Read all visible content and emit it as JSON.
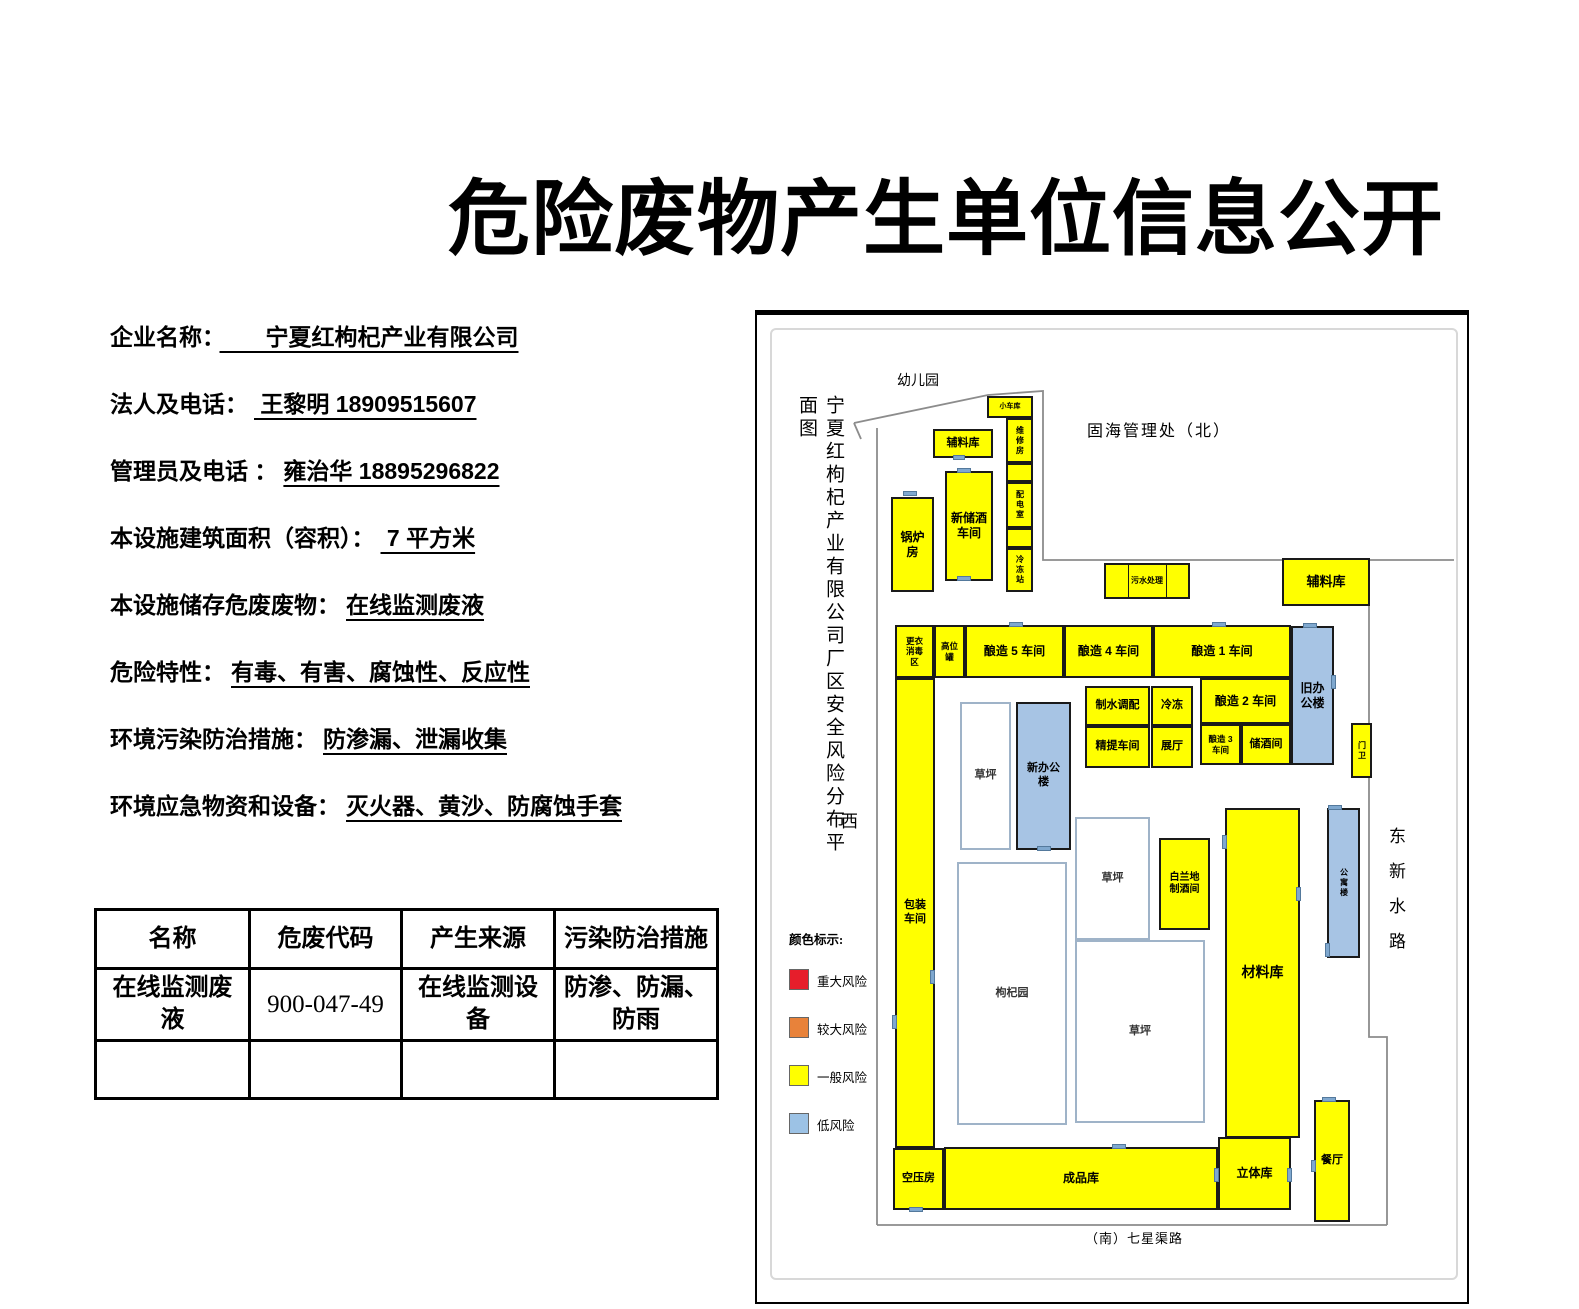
{
  "title": "危险废物产生单位信息公开",
  "info_fields": [
    {
      "label": "企业名称：",
      "value": "　　宁夏红枸杞产业有限公司"
    },
    {
      "label": "法人及电话：",
      "value": " 王黎明  18909515607"
    },
    {
      "label": "管理员及电话 ：",
      "value": "雍治华 18895296822"
    },
    {
      "label": "本设施建筑面积（容积）：",
      "value": "  7 平方米"
    },
    {
      "label": "本设施储存危废废物：",
      "value": "在线监测废液"
    },
    {
      "label": "危险特性：",
      "value": "有毒、有害、腐蚀性、反应性"
    },
    {
      "label": "环境污染防治措施：",
      "value": "防渗漏、泄漏收集"
    },
    {
      "label": "环境应急物资和设备：",
      "value": "灭火器、黄沙、防腐蚀手套"
    }
  ],
  "waste_table": {
    "headers": [
      "名称",
      "危废代码",
      "产生来源",
      "污染防治措施"
    ],
    "rows": [
      [
        "在线监测废液",
        "900-047-49",
        "在线监测设备",
        "防渗、防漏、防雨"
      ],
      [
        "",
        "",
        "",
        ""
      ]
    ]
  },
  "map": {
    "vertical_title": "宁夏红枸杞产业有限公司厂区安全风险分布平面图",
    "legend": {
      "title": "颜色标示:",
      "items": [
        {
          "label": "重大风险",
          "color": "#E61E2B"
        },
        {
          "label": "较大风险",
          "color": "#E8823A"
        },
        {
          "label": "一般风险",
          "color": "#FFFF00"
        },
        {
          "label": "低风险",
          "color": "#9CC2E5"
        }
      ]
    },
    "annotations": [
      {
        "id": "kindergarten",
        "text": "幼儿园",
        "x": 140,
        "y": 55,
        "fs": 14
      },
      {
        "id": "north-neighbor",
        "text": "固海管理处（北）",
        "x": 330,
        "y": 102,
        "fs": 16,
        "ls": 2
      },
      {
        "id": "west",
        "text": "西",
        "x": 84,
        "y": 492,
        "fs": 17
      },
      {
        "id": "east-road",
        "text": "东新水路",
        "x": 626,
        "y": 512,
        "fs": 17,
        "ls": 18,
        "vert": true
      },
      {
        "id": "south-road",
        "text": "（南）七星渠路",
        "x": 328,
        "y": 913,
        "fs": 13,
        "ls": 1
      }
    ],
    "buildings": [
      {
        "id": "xiao-che-ku",
        "label": "小车库",
        "x": 230,
        "y": 81,
        "w": 46,
        "h": 22,
        "color": "yellow",
        "fs": 7
      },
      {
        "id": "weixiufang",
        "label": "维修房",
        "x": 249,
        "y": 103,
        "w": 27,
        "h": 45,
        "color": "yellow",
        "fs": 8,
        "vert": true
      },
      {
        "id": "blank-1",
        "label": "",
        "x": 249,
        "y": 148,
        "w": 27,
        "h": 19,
        "color": "yellow",
        "fs": 8
      },
      {
        "id": "peidianshi",
        "label": "配电室",
        "x": 249,
        "y": 167,
        "w": 27,
        "h": 46,
        "color": "yellow",
        "fs": 8,
        "vert": true
      },
      {
        "id": "blank-2",
        "label": "",
        "x": 249,
        "y": 213,
        "w": 27,
        "h": 20,
        "color": "yellow",
        "fs": 8
      },
      {
        "id": "lengdongzhan",
        "label": "冷冻站",
        "x": 249,
        "y": 233,
        "w": 27,
        "h": 44,
        "color": "yellow",
        "fs": 8,
        "vert": true
      },
      {
        "id": "fuliaoku-left",
        "label": "辅料库",
        "x": 176,
        "y": 114,
        "w": 60,
        "h": 29,
        "color": "yellow",
        "fs": 11
      },
      {
        "id": "xinchujiu",
        "label": "新储酒\n车间",
        "x": 188,
        "y": 156,
        "w": 48,
        "h": 110,
        "color": "yellow",
        "fs": 12
      },
      {
        "id": "guolufang",
        "label": "锅炉\n房",
        "x": 134,
        "y": 182,
        "w": 43,
        "h": 95,
        "color": "yellow",
        "fs": 12
      },
      {
        "id": "wushuichuli",
        "label": "污水处理",
        "x": 347,
        "y": 248,
        "w": 86,
        "h": 36,
        "color": "yellow",
        "fs": 8,
        "dividers": [
          27,
          73
        ]
      },
      {
        "id": "fuliaoku-right",
        "label": "辅料库",
        "x": 525,
        "y": 243,
        "w": 88,
        "h": 48,
        "color": "yellow",
        "fs": 13
      },
      {
        "id": "gengyi-xiaodu",
        "label": "更衣\n消毒\n区",
        "x": 138,
        "y": 310,
        "w": 39,
        "h": 53,
        "color": "yellow",
        "fs": 8.5
      },
      {
        "id": "gaoweiguan",
        "label": "高位\n罐",
        "x": 177,
        "y": 310,
        "w": 31,
        "h": 53,
        "color": "yellow",
        "fs": 8.5
      },
      {
        "id": "niangzao-5",
        "label": "酿造 5 车间",
        "x": 208,
        "y": 310,
        "w": 99,
        "h": 53,
        "color": "yellow",
        "fs": 12
      },
      {
        "id": "niangzao-4",
        "label": "酿造 4 车间",
        "x": 307,
        "y": 310,
        "w": 89,
        "h": 53,
        "color": "yellow",
        "fs": 12
      },
      {
        "id": "niangzao-1",
        "label": "酿造 1 车间",
        "x": 396,
        "y": 310,
        "w": 138,
        "h": 53,
        "color": "yellow",
        "fs": 12
      },
      {
        "id": "jiu-bangonglou",
        "label": "旧办\n公楼",
        "x": 534,
        "y": 311,
        "w": 43,
        "h": 139,
        "color": "blue",
        "fs": 12
      },
      {
        "id": "menwei",
        "label": "门卫",
        "x": 594,
        "y": 408,
        "w": 21,
        "h": 55,
        "color": "yellow",
        "fs": 8,
        "vert": true
      },
      {
        "id": "zhishui-tiaopei",
        "label": "制水调配",
        "x": 328,
        "y": 371,
        "w": 65,
        "h": 40,
        "color": "yellow",
        "fs": 11
      },
      {
        "id": "lengdong",
        "label": "冷冻",
        "x": 394,
        "y": 371,
        "w": 42,
        "h": 40,
        "color": "yellow",
        "fs": 11
      },
      {
        "id": "niangzao-2",
        "label": "酿造 2 车间",
        "x": 443,
        "y": 363,
        "w": 91,
        "h": 46,
        "color": "yellow",
        "fs": 12
      },
      {
        "id": "jingti-chejian",
        "label": "精提车间",
        "x": 328,
        "y": 411,
        "w": 65,
        "h": 42,
        "color": "yellow",
        "fs": 11
      },
      {
        "id": "zhanting",
        "label": "展厅",
        "x": 394,
        "y": 411,
        "w": 42,
        "h": 42,
        "color": "yellow",
        "fs": 11
      },
      {
        "id": "niangzao-3",
        "label": "酿造 3\n车间",
        "x": 443,
        "y": 409,
        "w": 41,
        "h": 41,
        "color": "yellow",
        "fs": 8.5
      },
      {
        "id": "chujiujian",
        "label": "储酒间",
        "x": 484,
        "y": 409,
        "w": 50,
        "h": 41,
        "color": "yellow",
        "fs": 11
      },
      {
        "id": "caoping-1",
        "label": "草坪",
        "x": 203,
        "y": 387,
        "w": 51,
        "h": 148,
        "color": "white",
        "fs": 11
      },
      {
        "id": "xin-bangonglou",
        "label": "新办公\n楼",
        "x": 259,
        "y": 387,
        "w": 55,
        "h": 148,
        "color": "blue",
        "fs": 11
      },
      {
        "id": "baozhuang",
        "label": "包装\n车间",
        "x": 138,
        "y": 363,
        "w": 40,
        "h": 470,
        "color": "yellow",
        "fs": 11
      },
      {
        "id": "gouqiyuan",
        "label": "枸杞园",
        "x": 200,
        "y": 547,
        "w": 110,
        "h": 263,
        "color": "white",
        "fs": 11
      },
      {
        "id": "caoping-2",
        "label": "草坪",
        "x": 318,
        "y": 502,
        "w": 75,
        "h": 123,
        "color": "white",
        "fs": 11
      },
      {
        "id": "bailandi",
        "label": "白兰地\n制酒间",
        "x": 402,
        "y": 523,
        "w": 51,
        "h": 92,
        "color": "yellow",
        "fs": 10
      },
      {
        "id": "caoping-3",
        "label": "草坪",
        "x": 318,
        "y": 625,
        "w": 130,
        "h": 183,
        "color": "white",
        "fs": 11
      },
      {
        "id": "cailiaoku",
        "label": "材料库",
        "x": 468,
        "y": 493,
        "w": 75,
        "h": 330,
        "color": "yellow",
        "fs": 14
      },
      {
        "id": "gongyulou",
        "label": "公寓楼",
        "x": 570,
        "y": 493,
        "w": 33,
        "h": 150,
        "color": "blue",
        "fs": 8,
        "vert": true
      },
      {
        "id": "kongyafang",
        "label": "空压房",
        "x": 136,
        "y": 833,
        "w": 51,
        "h": 62,
        "color": "yellow",
        "fs": 11
      },
      {
        "id": "chengpinku",
        "label": "成品库",
        "x": 187,
        "y": 832,
        "w": 274,
        "h": 63,
        "color": "yellow",
        "fs": 12
      },
      {
        "id": "litiku",
        "label": "立体库",
        "x": 461,
        "y": 822,
        "w": 73,
        "h": 73,
        "color": "yellow",
        "fs": 12
      },
      {
        "id": "canting",
        "label": "餐厅",
        "x": 557,
        "y": 785,
        "w": 36,
        "h": 122,
        "color": "yellow",
        "fs": 11
      }
    ],
    "doors": [
      {
        "x": 146,
        "y": 176,
        "w": 14,
        "h": 5
      },
      {
        "x": 200,
        "y": 153,
        "w": 14,
        "h": 5
      },
      {
        "x": 200,
        "y": 261,
        "w": 14,
        "h": 5
      },
      {
        "x": 196,
        "y": 140,
        "w": 12,
        "h": 5
      },
      {
        "x": 252,
        "y": 307,
        "w": 14,
        "h": 5
      },
      {
        "x": 455,
        "y": 307,
        "w": 14,
        "h": 5
      },
      {
        "x": 546,
        "y": 308,
        "w": 14,
        "h": 5
      },
      {
        "x": 574,
        "y": 360,
        "w": 5,
        "h": 14
      },
      {
        "x": 465,
        "y": 520,
        "w": 5,
        "h": 14
      },
      {
        "x": 539,
        "y": 572,
        "w": 5,
        "h": 14
      },
      {
        "x": 173,
        "y": 655,
        "w": 5,
        "h": 14
      },
      {
        "x": 135,
        "y": 700,
        "w": 5,
        "h": 14
      },
      {
        "x": 280,
        "y": 531,
        "w": 14,
        "h": 5
      },
      {
        "x": 571,
        "y": 490,
        "w": 14,
        "h": 5
      },
      {
        "x": 568,
        "y": 628,
        "w": 5,
        "h": 14
      },
      {
        "x": 355,
        "y": 829,
        "w": 14,
        "h": 5
      },
      {
        "x": 457,
        "y": 853,
        "w": 5,
        "h": 14
      },
      {
        "x": 530,
        "y": 853,
        "w": 5,
        "h": 14
      },
      {
        "x": 152,
        "y": 892,
        "w": 14,
        "h": 5
      },
      {
        "x": 565,
        "y": 782,
        "w": 14,
        "h": 5
      },
      {
        "x": 554,
        "y": 845,
        "w": 5,
        "h": 12
      }
    ]
  }
}
